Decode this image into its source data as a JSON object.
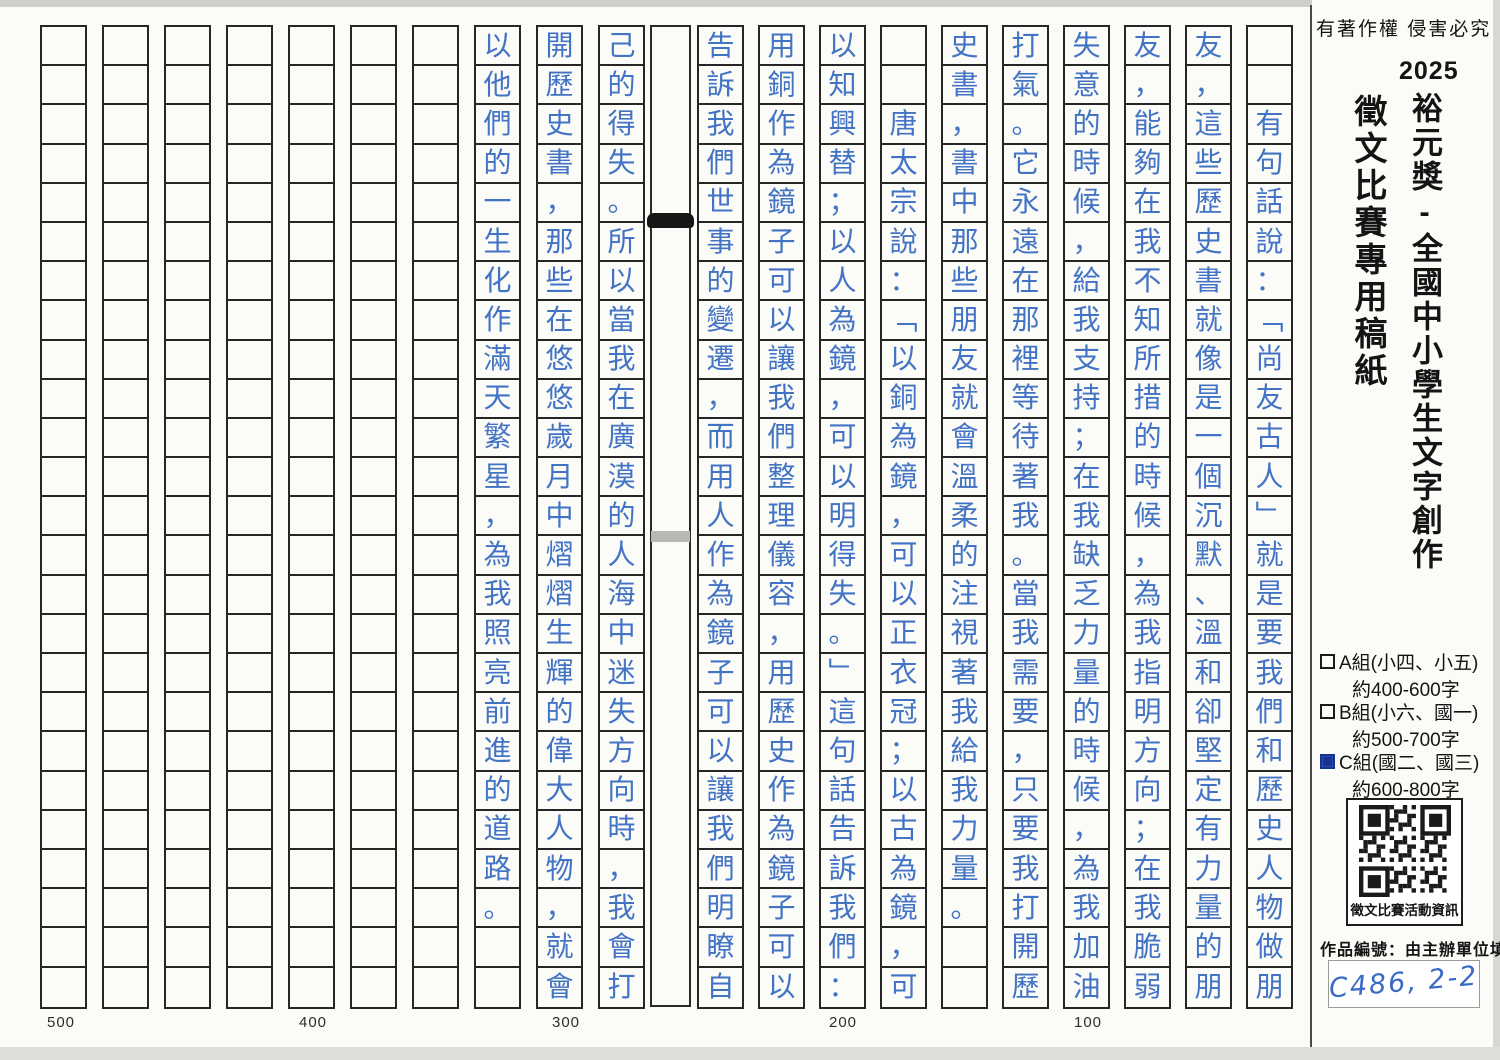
{
  "header": {
    "copyright": "有著作權 侵害必究",
    "year": "2025",
    "title_main": "裕元獎-全國中小學生文字創作",
    "title_sub": "徵文比賽專用稿紙"
  },
  "groups": [
    {
      "label": "A組(小四、小五)",
      "range": "約400-600字",
      "checked": false
    },
    {
      "label": "B組(小六、國一)",
      "range": "約500-700字",
      "checked": false
    },
    {
      "label": "C組(國二、國三)",
      "range": "約600-800字",
      "checked": true
    }
  ],
  "qr": {
    "caption": "徵文比賽活動資訊"
  },
  "entry_number": {
    "label": "作品編號：由主辦單位填寫",
    "value": "C486, 2-2"
  },
  "word_markers": [
    "500",
    "400",
    "300",
    "200",
    "100"
  ],
  "colors": {
    "ink_blue": "#4273c4",
    "checkbox_fill": "#16338f",
    "grid_line": "#262626"
  },
  "manuscript": {
    "rows_per_column": 25,
    "reading_order": "right-to-left, top-to-bottom",
    "pages": {
      "right": [
        {
          "offset": 2,
          "text": "有句話說：﹁尚友古人﹂就是要我們和歷史人物做朋"
        },
        {
          "offset": 0,
          "text": "友，這些歷史書就像是一個沉默、溫和卻堅定有力量的朋"
        },
        {
          "offset": 0,
          "text": "友，能夠在我不知所措的時候，為我指明方向；在我脆弱"
        },
        {
          "offset": 0,
          "text": "失意的時候，給我支持；在我缺乏力量的時候，為我加油"
        },
        {
          "offset": 0,
          "text": "打氣。它永遠在那裡等待著我。當我需要，只要我打開歷"
        },
        {
          "offset": 0,
          "text": "史書，書中那些朋友就會溫柔的注視著我給我力量。"
        },
        {
          "offset": 2,
          "text": "唐太宗說：﹁以銅為鏡，可以正衣冠；以古為鏡，可"
        },
        {
          "offset": 0,
          "text": "以知興替；以人為鏡，可以明得失。﹂這句話告訴我們："
        },
        {
          "offset": 0,
          "text": "用銅作為鏡子可以讓我們整理儀容，用歷史作為鏡子可以"
        },
        {
          "offset": 0,
          "text": "告訴我們世事的變遷，而用人作為鏡子可以讓我們明瞭自"
        }
      ],
      "left": [
        {
          "offset": 0,
          "text": "己的得失。所以當我在廣漠的人海中迷失方向時，我會打"
        },
        {
          "offset": 0,
          "text": "開歷史書，那些在悠悠歲月中熠熠生輝的偉大人物，就會"
        },
        {
          "offset": 0,
          "text": "以他們的一生化作滿天繁星，為我照亮前進的道路。"
        },
        {
          "offset": 0,
          "text": ""
        },
        {
          "offset": 0,
          "text": ""
        },
        {
          "offset": 0,
          "text": ""
        },
        {
          "offset": 0,
          "text": ""
        },
        {
          "offset": 0,
          "text": ""
        },
        {
          "offset": 0,
          "text": ""
        },
        {
          "offset": 0,
          "text": ""
        }
      ]
    }
  }
}
